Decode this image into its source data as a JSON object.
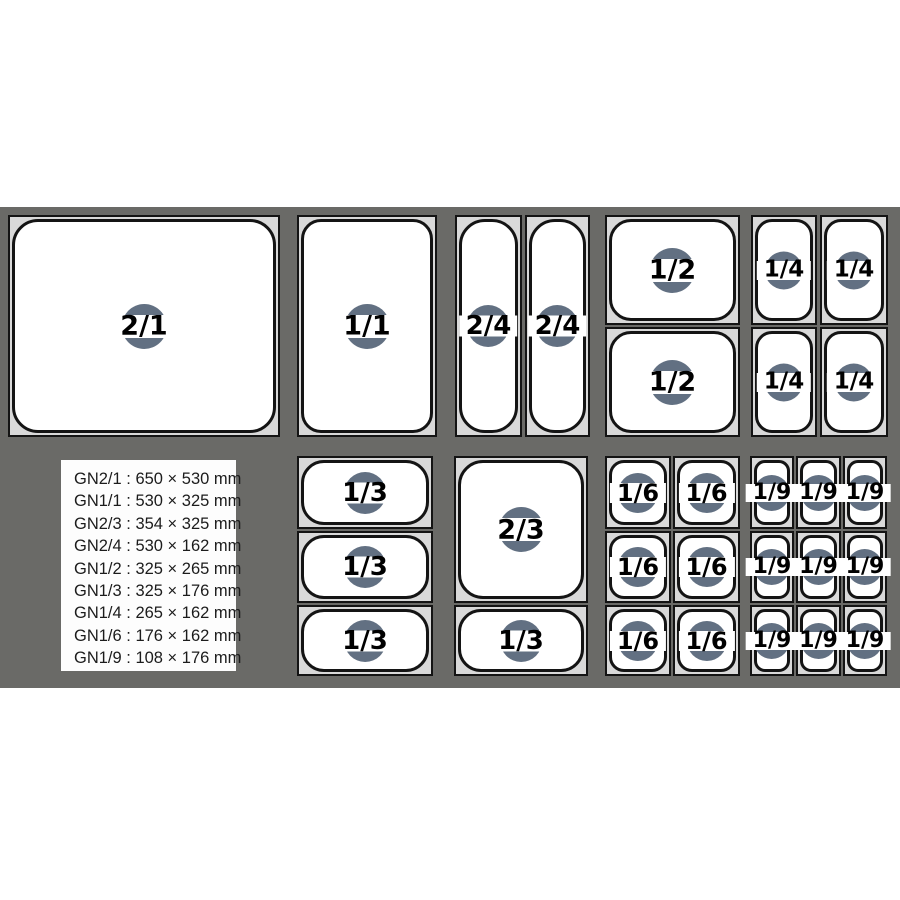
{
  "diagram": {
    "title": "Gastronorm pan size diagram",
    "colors": {
      "background": "#ffffff",
      "band": "#6a6a67",
      "frame": "#d9d9d9",
      "pan_fill": "#ffffff",
      "outline": "#141414",
      "badge_circle": "#627082",
      "badge_stripe": "#ffffff",
      "label_text": "#000000",
      "legend_bg": "#fdfdfd",
      "legend_text": "#1c1c1c"
    }
  },
  "pans": {
    "gn21": [
      "2/1"
    ],
    "gn11": [
      "1/1"
    ],
    "gn24": [
      "2/4",
      "2/4"
    ],
    "gn12": [
      "1/2",
      "1/2"
    ],
    "gn14": [
      "1/4",
      "1/4",
      "1/4",
      "1/4"
    ],
    "gn13": [
      "1/3",
      "1/3",
      "1/3"
    ],
    "gn23": [
      "2/3",
      "1/3"
    ],
    "gn16": [
      "1/6",
      "1/6",
      "1/6",
      "1/6",
      "1/6",
      "1/6"
    ],
    "gn19": [
      "1/9",
      "1/9",
      "1/9",
      "1/9",
      "1/9",
      "1/9",
      "1/9",
      "1/9",
      "1/9"
    ]
  },
  "legend": {
    "items": [
      "GN2/1 : 650 × 530 mm",
      "GN1/1 : 530 × 325 mm",
      "GN2/3 : 354 × 325 mm",
      "GN2/4 : 530 × 162 mm",
      "GN1/2 : 325 × 265 mm",
      "GN1/3 : 325 × 176 mm",
      "GN1/4 : 265 × 162 mm",
      "GN1/6 : 176 × 162 mm",
      "GN1/9 : 108 × 176 mm"
    ]
  }
}
